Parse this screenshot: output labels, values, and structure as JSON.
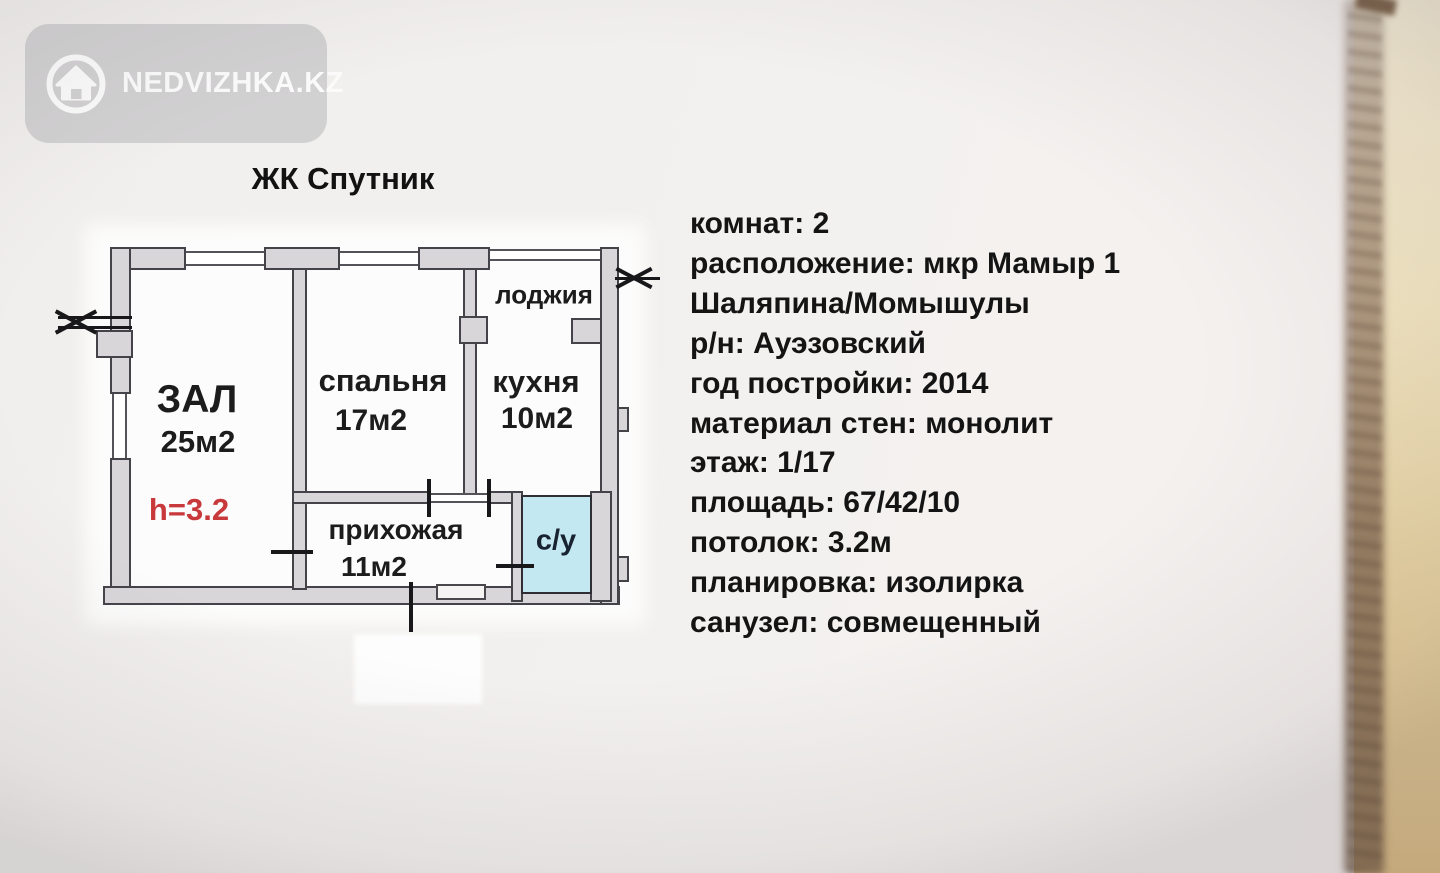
{
  "brand": {
    "name": "NEDVIZHKA.KZ"
  },
  "title": "ЖК Спутник",
  "floorplan": {
    "zal": {
      "label": "ЗАЛ",
      "area": "25м2",
      "height_note": "h=3.2"
    },
    "spalnya": {
      "label": "спальня",
      "area": "17м2"
    },
    "kuhnya": {
      "label": "кухня",
      "area": "10м2"
    },
    "lodzhiya": {
      "label": "лоджия"
    },
    "prihozhaya": {
      "label": "прихожая",
      "area": "11м2"
    },
    "sanuzel": {
      "label": "с/у"
    }
  },
  "details": {
    "lines": [
      "комнат: 2",
      "расположение: мкр Мамыр 1",
      "Шаляпина/Момышулы",
      "р/н: Ауэзовский",
      "год постройки: 2014",
      "материал стен: монолит",
      "этаж: 1/17",
      "площадь: 67/42/10",
      "потолок: 3.2м",
      "планировка: изолирка",
      "санузел: совмещенный"
    ]
  },
  "colors": {
    "badge_bg": "#d2d1d2",
    "badge_text": "#fbfbfb",
    "height_note": "#c8393c",
    "sanuzel_fill": "#c3e8f1",
    "paper_edge": "#dcbc85"
  }
}
